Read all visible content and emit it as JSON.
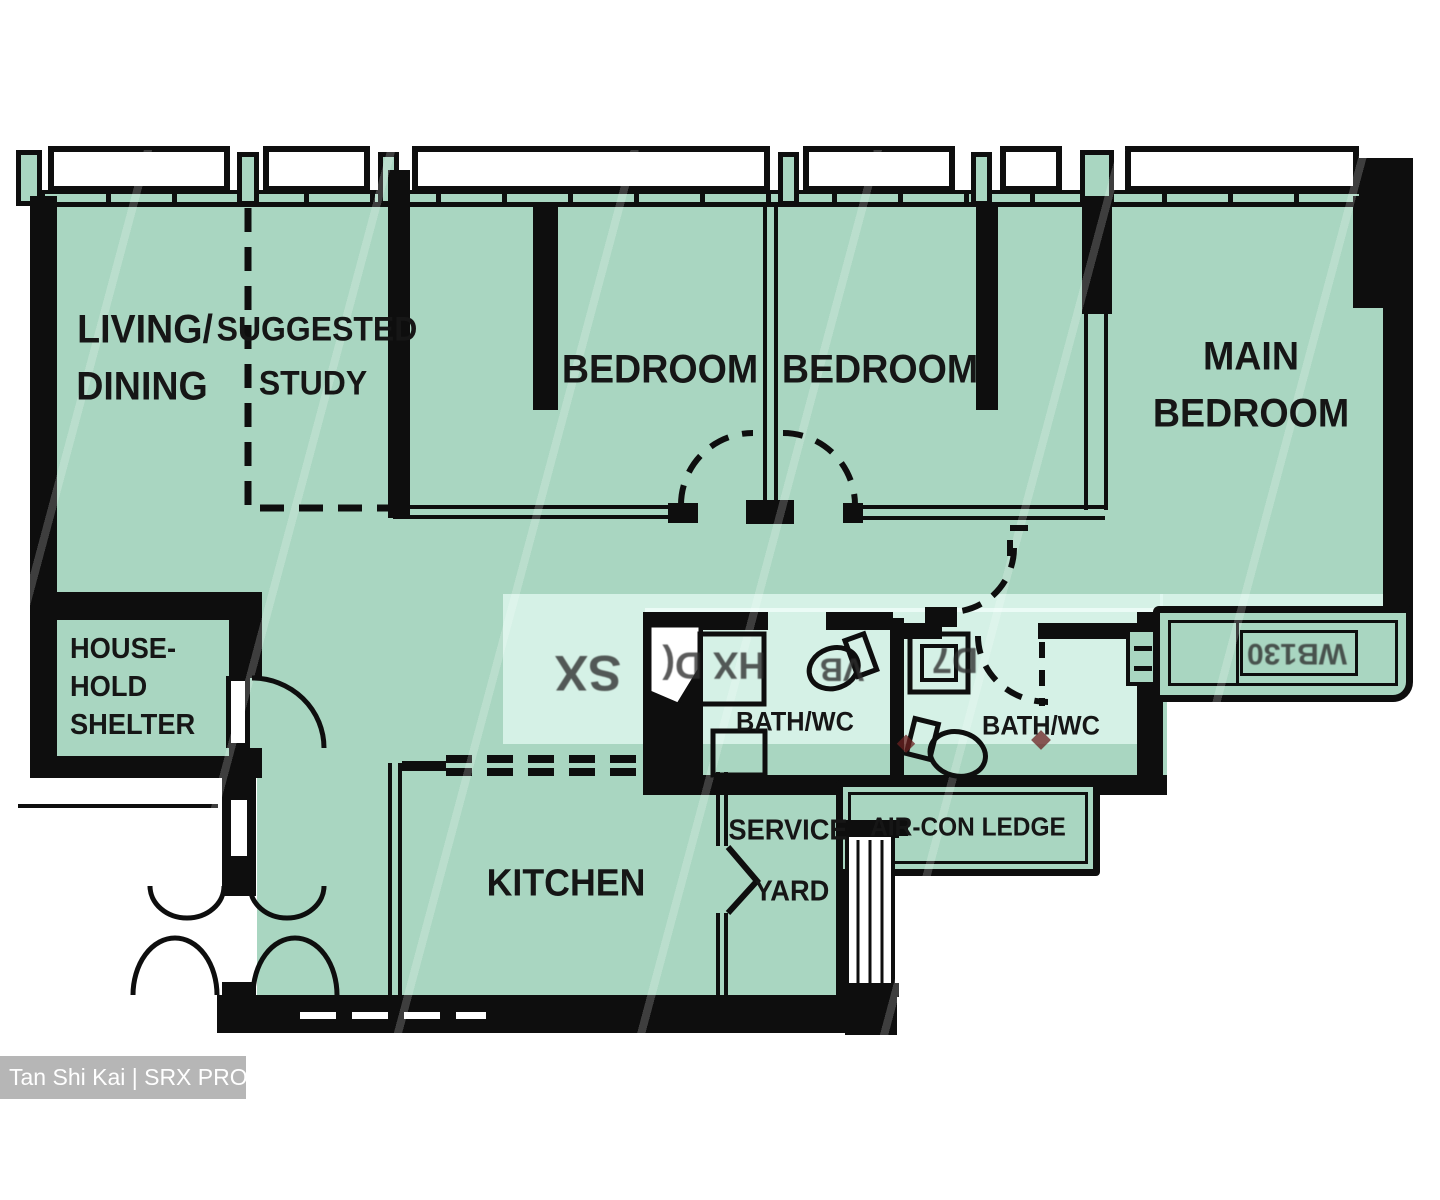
{
  "plan_title": "3-room-flexi floor plan",
  "colors": {
    "room_fill": "#a9d6c1",
    "wall": "#0e0e0e",
    "light_band": "#e4f8f1",
    "watermark_bg": "#b2b2b2",
    "watermark_text": "#ffffff"
  },
  "rooms": {
    "living": {
      "line1": "LIVING/",
      "line2": "DINING"
    },
    "study": {
      "line1": "SUGGESTED",
      "line2": "STUDY"
    },
    "bedroom1": {
      "label": "BEDROOM"
    },
    "bedroom2": {
      "label": "BEDROOM"
    },
    "main": {
      "line1": "MAIN",
      "line2": "BEDROOM"
    },
    "shelter": {
      "line1": "HOUSE-",
      "line2": "HOLD",
      "line3": "SHELTER"
    },
    "bath1": {
      "label": "BATH/WC"
    },
    "bath2": {
      "label": "BATH/WC"
    },
    "kitchen": {
      "label": "KITCHEN"
    },
    "service_yard": {
      "line1": "SERVICE",
      "line2": "YARD"
    },
    "aircon": {
      "label": "AIR-CON LEDGE"
    }
  },
  "watermark": {
    "text": "Tan Shi Kai | SRX PROPERTY"
  },
  "artifacts": {
    "note": "mirrored/garbled flipped-watermark glyphs visible in light band",
    "fragments": [
      {
        "text": "SX"
      },
      {
        "text": "HX D("
      },
      {
        "text": "VB"
      },
      {
        "text": "D7"
      },
      {
        "text": "WB130"
      }
    ]
  }
}
